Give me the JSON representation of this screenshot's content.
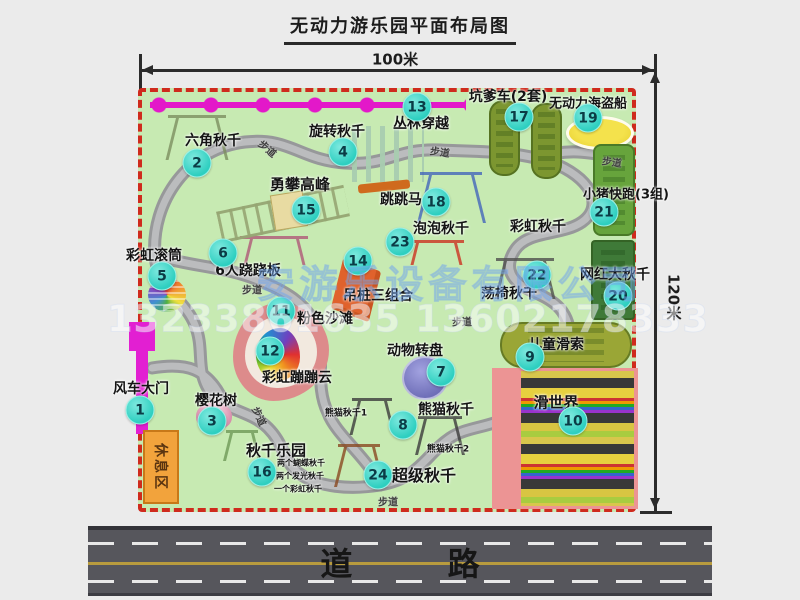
{
  "title": "无动力游乐园平面布局图",
  "dimensions": {
    "top": "100米",
    "right": "120米"
  },
  "watermark": {
    "company": "安游乐设备有限公司",
    "phone": "13233861635 13602178333"
  },
  "road": {
    "label": "道 路"
  },
  "rest_area": {
    "label": "休息区"
  },
  "path_label": "步道",
  "path_labels": [
    {
      "x": 268,
      "y": 148,
      "rot": 40
    },
    {
      "x": 440,
      "y": 151,
      "rot": 8
    },
    {
      "x": 612,
      "y": 161,
      "rot": 8
    },
    {
      "x": 252,
      "y": 289,
      "rot": 0
    },
    {
      "x": 462,
      "y": 321,
      "rot": 0
    },
    {
      "x": 260,
      "y": 416,
      "rot": 65
    },
    {
      "x": 388,
      "y": 501,
      "rot": 0
    }
  ],
  "extra_labels": [
    {
      "text": "彩虹秋千",
      "x": 538,
      "y": 226,
      "size": 14
    },
    {
      "text": "熊猫秋千1",
      "x": 346,
      "y": 412,
      "size": 9
    },
    {
      "text": "熊猫秋千2",
      "x": 448,
      "y": 448,
      "size": 9
    },
    {
      "text": "两个蝴蝶秋千",
      "x": 301,
      "y": 463,
      "size": 8
    },
    {
      "text": "两个发光秋千",
      "x": 300,
      "y": 476,
      "size": 8
    },
    {
      "text": "一个彩虹秋千",
      "x": 298,
      "y": 489,
      "size": 8
    }
  ],
  "attractions": [
    {
      "num": "1",
      "name": "风车大门",
      "label": {
        "x": 141,
        "y": 388,
        "size": 14
      },
      "badge": {
        "x": 140,
        "y": 410
      },
      "icons": [
        {
          "name": "windmill-gate-icon",
          "type": "gate",
          "x": 129,
          "y": 322,
          "w": 26,
          "h": 112
        }
      ]
    },
    {
      "num": "2",
      "name": "六角秋千",
      "label": {
        "x": 213,
        "y": 140,
        "size": 14
      },
      "badge": {
        "x": 197,
        "y": 163
      },
      "icons": [
        {
          "name": "hex-swing-frame-icon",
          "type": "sketch",
          "x": 168,
          "y": 115,
          "w": 58,
          "h": 42,
          "c": "#7d8f60"
        }
      ]
    },
    {
      "num": "3",
      "name": "樱花树",
      "label": {
        "x": 216,
        "y": 400,
        "size": 14
      },
      "badge": {
        "x": 212,
        "y": 421
      },
      "icons": [
        {
          "name": "cherry-tree-icon",
          "type": "tree",
          "x": 196,
          "y": 402,
          "w": 36,
          "h": 28
        }
      ]
    },
    {
      "num": "4",
      "name": "旋转秋千",
      "label": {
        "x": 337,
        "y": 131,
        "size": 14
      },
      "badge": {
        "x": 343,
        "y": 152
      },
      "icons": [
        {
          "name": "rotating-swing-icon",
          "type": "carousel",
          "x": 352,
          "y": 126,
          "w": 72,
          "h": 68
        }
      ]
    },
    {
      "num": "5",
      "name": "彩虹滚筒",
      "label": {
        "x": 154,
        "y": 255,
        "size": 14
      },
      "badge": {
        "x": 162,
        "y": 276
      },
      "icons": [
        {
          "name": "rainbow-roller-icon",
          "type": "roller",
          "x": 148,
          "y": 278,
          "w": 38,
          "h": 34
        }
      ]
    },
    {
      "num": "6",
      "name": "6人跷跷板",
      "label": {
        "x": 248,
        "y": 270,
        "size": 14
      },
      "badge": {
        "x": 223,
        "y": 253
      },
      "icons": [
        {
          "name": "seesaw-icon",
          "type": "sketch",
          "x": 240,
          "y": 236,
          "w": 68,
          "h": 26,
          "c": "#b05878"
        }
      ]
    },
    {
      "num": "7",
      "name": "动物转盘",
      "label": {
        "x": 415,
        "y": 350,
        "size": 14
      },
      "badge": {
        "x": 441,
        "y": 372
      },
      "icons": [
        {
          "name": "animal-turntable-icon",
          "type": "circle",
          "x": 402,
          "y": 356,
          "w": 42,
          "h": 40
        }
      ]
    },
    {
      "num": "8",
      "name": "熊猫秋千",
      "label": {
        "x": 446,
        "y": 409,
        "size": 14
      },
      "badge": {
        "x": 403,
        "y": 425
      },
      "icons": [
        {
          "name": "panda-swing-1-icon",
          "type": "sketch",
          "x": 352,
          "y": 398,
          "w": 40,
          "h": 34,
          "c": "#3c3c3c"
        },
        {
          "name": "panda-swing-2-icon",
          "type": "sketch",
          "x": 418,
          "y": 416,
          "w": 44,
          "h": 36,
          "c": "#3c3c3c"
        }
      ]
    },
    {
      "num": "9",
      "name": "儿童滑索",
      "label": {
        "x": 556,
        "y": 344,
        "size": 14
      },
      "badge": {
        "x": 530,
        "y": 357
      },
      "icons": [
        {
          "name": "kids-zipline-pad-icon",
          "type": "pad",
          "x": 500,
          "y": 322,
          "w": 132,
          "h": 46,
          "c": "#9aa636",
          "r": 22
        }
      ]
    },
    {
      "num": "10",
      "name": "滑世界",
      "label": {
        "x": 556,
        "y": 402,
        "size": 15
      },
      "badge": {
        "x": 573,
        "y": 421
      },
      "icons": [
        {
          "name": "slide-world-icon",
          "type": "slideworld",
          "x": 492,
          "y": 368,
          "w": 146,
          "h": 141
        }
      ]
    },
    {
      "num": "11",
      "name": "粉色沙滩",
      "label": {
        "x": 325,
        "y": 318,
        "size": 14
      },
      "badge": {
        "x": 281,
        "y": 311
      },
      "icons": []
    },
    {
      "num": "12",
      "name": "彩虹蹦蹦云",
      "label": {
        "x": 297,
        "y": 377,
        "size": 14
      },
      "badge": {
        "x": 270,
        "y": 351
      },
      "icons": [
        {
          "name": "pink-beach-cloud-icon",
          "type": "blob",
          "x": 233,
          "y": 303,
          "w": 96,
          "h": 98
        }
      ]
    },
    {
      "num": "13",
      "name": "丛林穿越",
      "label": {
        "x": 421,
        "y": 123,
        "size": 14
      },
      "badge": {
        "x": 417,
        "y": 107
      },
      "icons": [
        {
          "name": "jungle-crossing-line-icon",
          "type": "dots",
          "x": 150,
          "y": 96,
          "w": 316,
          "h": 18
        }
      ]
    },
    {
      "num": "14",
      "name": "吊桩三组合",
      "label": {
        "x": 378,
        "y": 295,
        "size": 14
      },
      "badge": {
        "x": 358,
        "y": 261
      },
      "icons": [
        {
          "name": "hanging-piles-icon",
          "type": "para",
          "x": 336,
          "y": 264,
          "w": 40,
          "h": 52
        }
      ]
    },
    {
      "num": "15",
      "name": "勇攀高峰",
      "label": {
        "x": 300,
        "y": 184,
        "size": 15
      },
      "badge": {
        "x": 306,
        "y": 210
      },
      "icons": [
        {
          "name": "climbing-ladder-icon",
          "type": "ladder",
          "x": 218,
          "y": 198,
          "w": 130,
          "h": 32,
          "rot": -12
        }
      ]
    },
    {
      "num": "16",
      "name": "秋千乐园",
      "label": {
        "x": 276,
        "y": 450,
        "size": 15
      },
      "badge": {
        "x": 262,
        "y": 472
      },
      "icons": [
        {
          "name": "swing-park-frame-icon",
          "type": "sketch",
          "x": 226,
          "y": 430,
          "w": 32,
          "h": 28,
          "c": "#6f9a58"
        }
      ]
    },
    {
      "num": "17",
      "name": "坑爹车(2套)",
      "label": {
        "x": 508,
        "y": 96,
        "size": 14
      },
      "badge": {
        "x": 519,
        "y": 117
      },
      "icons": [
        {
          "name": "pit-car-track-1-icon",
          "type": "pad",
          "x": 489,
          "y": 100,
          "w": 31,
          "h": 76,
          "c": "#7c9630",
          "r": 14
        },
        {
          "name": "pit-car-track-2-icon",
          "type": "pad",
          "x": 531,
          "y": 103,
          "w": 31,
          "h": 76,
          "c": "#7c9630",
          "r": 14
        }
      ]
    },
    {
      "num": "18",
      "name": "跳跳马",
      "label": {
        "x": 401,
        "y": 199,
        "size": 14
      },
      "badge": {
        "x": 436,
        "y": 202
      },
      "icons": [
        {
          "name": "jumping-horse-icon",
          "type": "sketch",
          "x": 420,
          "y": 172,
          "w": 62,
          "h": 48,
          "c": "#4466bb"
        }
      ]
    },
    {
      "num": "19",
      "name": "无动力海盗船",
      "label": {
        "x": 588,
        "y": 102,
        "size": 13
      },
      "badge": {
        "x": 588,
        "y": 118
      },
      "icons": [
        {
          "name": "pirate-ship-icon",
          "type": "ellipse",
          "x": 566,
          "y": 116,
          "w": 62,
          "h": 28
        }
      ]
    },
    {
      "num": "20",
      "name": "网红大秋千",
      "label": {
        "x": 615,
        "y": 274,
        "size": 14
      },
      "badge": {
        "x": 618,
        "y": 296
      },
      "icons": [
        {
          "name": "big-swing-pad-icon",
          "type": "pad",
          "x": 591,
          "y": 240,
          "w": 44,
          "h": 80,
          "c": "#3f7a38",
          "r": 4
        }
      ]
    },
    {
      "num": "21",
      "name": "小猪快跑(3组)",
      "label": {
        "x": 626,
        "y": 193,
        "size": 13
      },
      "badge": {
        "x": 604,
        "y": 212
      },
      "icons": [
        {
          "name": "piggy-run-pad-icon",
          "type": "pad",
          "x": 593,
          "y": 144,
          "w": 42,
          "h": 92,
          "c": "#67a43c",
          "r": 8
        }
      ]
    },
    {
      "num": "22",
      "name": "荡椅秋千",
      "label": {
        "x": 509,
        "y": 293,
        "size": 14
      },
      "badge": {
        "x": 537,
        "y": 275
      },
      "icons": [
        {
          "name": "swing-chair-icon",
          "type": "sketch",
          "x": 496,
          "y": 258,
          "w": 58,
          "h": 38,
          "c": "#50504e"
        }
      ]
    },
    {
      "num": "23",
      "name": "泡泡秋千",
      "label": {
        "x": 441,
        "y": 228,
        "size": 14
      },
      "badge": {
        "x": 400,
        "y": 242
      },
      "icons": [
        {
          "name": "bubble-swing-icon",
          "type": "sketch",
          "x": 408,
          "y": 240,
          "w": 56,
          "h": 22,
          "c": "#cc3322"
        }
      ]
    },
    {
      "num": "24",
      "name": "超级秋千",
      "label": {
        "x": 424,
        "y": 474,
        "size": 16
      },
      "badge": {
        "x": 378,
        "y": 475
      },
      "icons": [
        {
          "name": "super-swing-icon",
          "type": "sketch",
          "x": 338,
          "y": 444,
          "w": 42,
          "h": 40,
          "c": "#8a4a22"
        }
      ]
    }
  ]
}
